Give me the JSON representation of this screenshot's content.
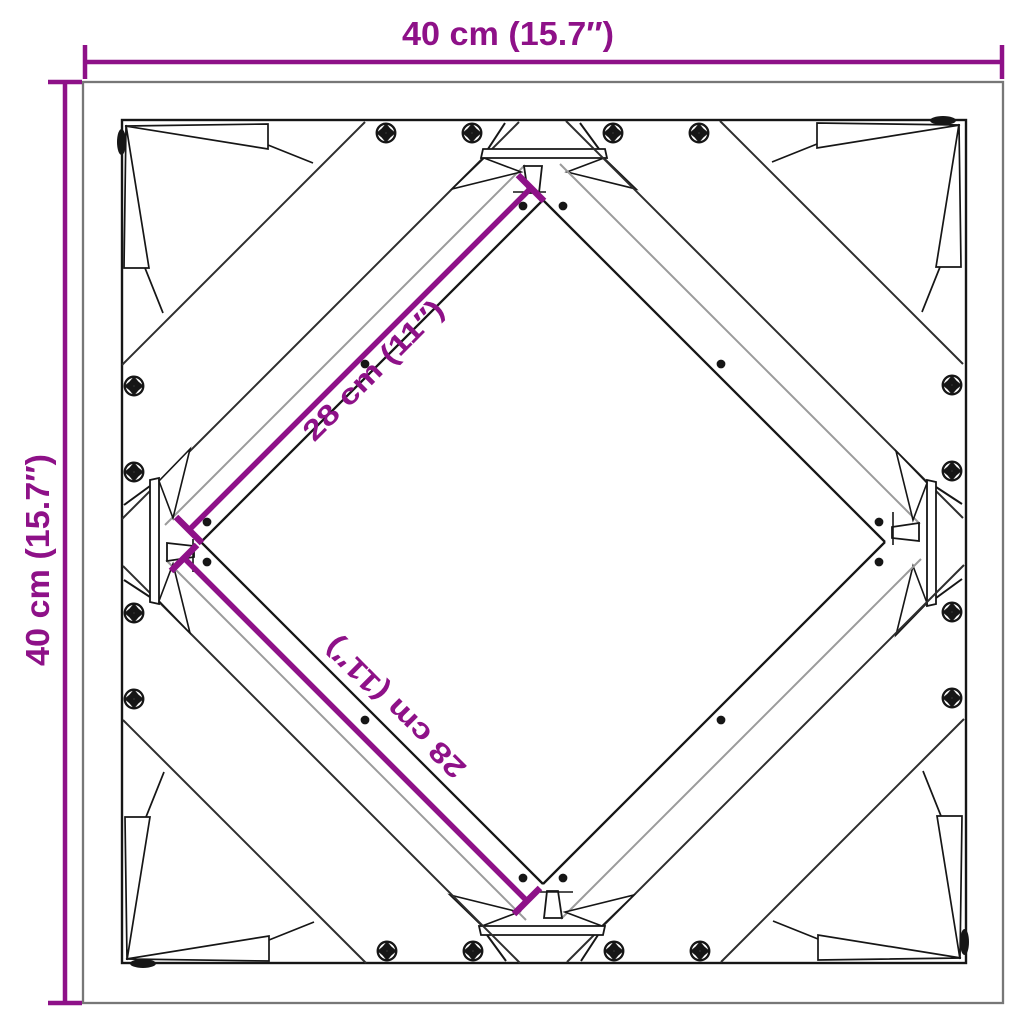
{
  "diagram": {
    "kind": "square table-frame cross-brace dimension drawing (top view)",
    "labels": {
      "top_width": "40 cm (15.7″)",
      "left_height": "40 cm (15.7″)",
      "diagonal_upper": "28 cm (11″)",
      "diagonal_lower": "28 cm (11″)"
    }
  },
  "colors": {
    "dimension_accent": "#8E1188",
    "line_dark": "#161616",
    "line_gray": "#9b9b9b",
    "frame_outline": "#777777",
    "background": "#ffffff"
  },
  "icons": {
    "screw": "phillips-screw-icon",
    "hole": "pilot-hole-icon"
  }
}
